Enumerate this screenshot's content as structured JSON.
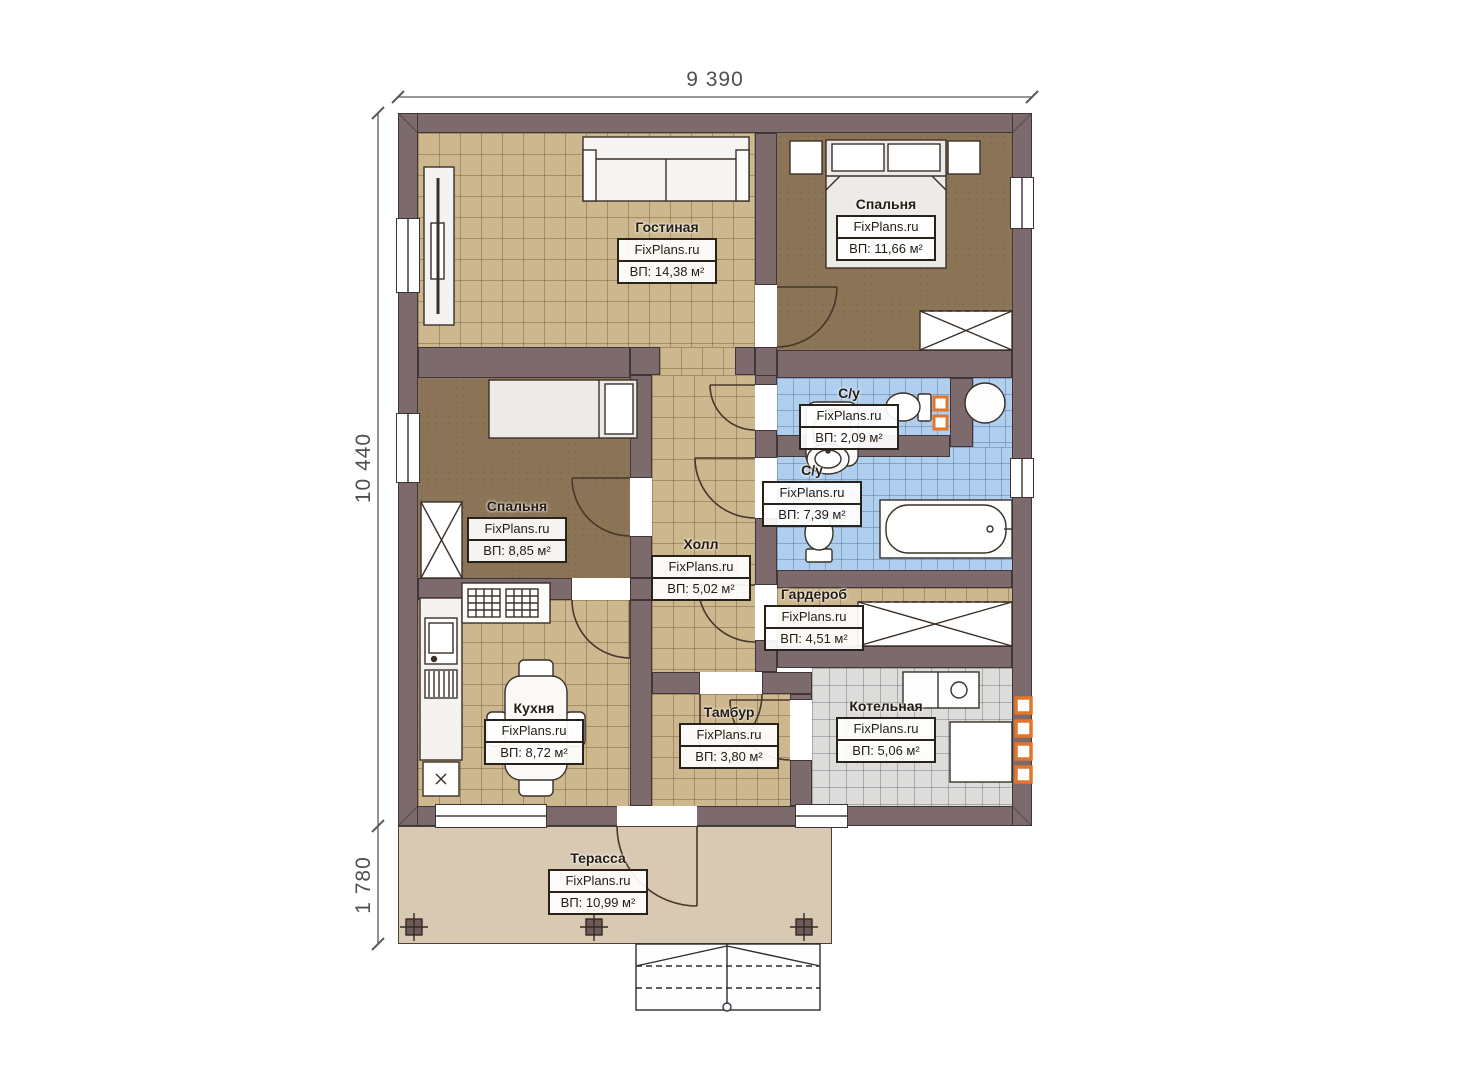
{
  "plan": {
    "brand": "FixPlans.ru",
    "dimensions": {
      "total_width": "9 390",
      "main_depth": "10 440",
      "terrace_depth": "1 780"
    },
    "rooms": {
      "living": {
        "name": "Гостиная",
        "watermark": "FixPlans.ru",
        "area": "ВП: 14,38 м²"
      },
      "bedroom_master": {
        "name": "Спальня",
        "watermark": "FixPlans.ru",
        "area": "ВП: 11,66 м²"
      },
      "bedroom_second": {
        "name": "Спальня",
        "watermark": "FixPlans.ru",
        "area": "ВП: 8,85 м²"
      },
      "hall": {
        "name": "Холл",
        "watermark": "FixPlans.ru",
        "area": "ВП: 5,02 м²"
      },
      "wc_small": {
        "name": "С/у",
        "watermark": "FixPlans.ru",
        "area": "ВП: 2,09 м²"
      },
      "wc_big": {
        "name": "С/у",
        "watermark": "FixPlans.ru",
        "area": "ВП: 7,39 м²"
      },
      "wardrobe": {
        "name": "Гардероб",
        "watermark": "FixPlans.ru",
        "area": "ВП: 4,51 м²"
      },
      "kitchen": {
        "name": "Кухня",
        "watermark": "FixPlans.ru",
        "area": "ВП: 8,72 м²"
      },
      "tambour": {
        "name": "Тамбур",
        "watermark": "FixPlans.ru",
        "area": "ВП: 3,80 м²"
      },
      "boiler": {
        "name": "Котельная",
        "watermark": "FixPlans.ru",
        "area": "ВП: 5,06 м²"
      },
      "terrace": {
        "name": "Терасса",
        "watermark": "FixPlans.ru",
        "area": "ВП: 10,99 м²"
      }
    },
    "colors": {
      "wall": "#7d6a6c",
      "tile_tan": "#cdb78e",
      "tile_blue": "#b0cfee",
      "tile_gray": "#dcdcda",
      "floor_brown": "#8c7457",
      "terrace": "#d9c9b2",
      "accent_orange": "#e2762f"
    }
  }
}
